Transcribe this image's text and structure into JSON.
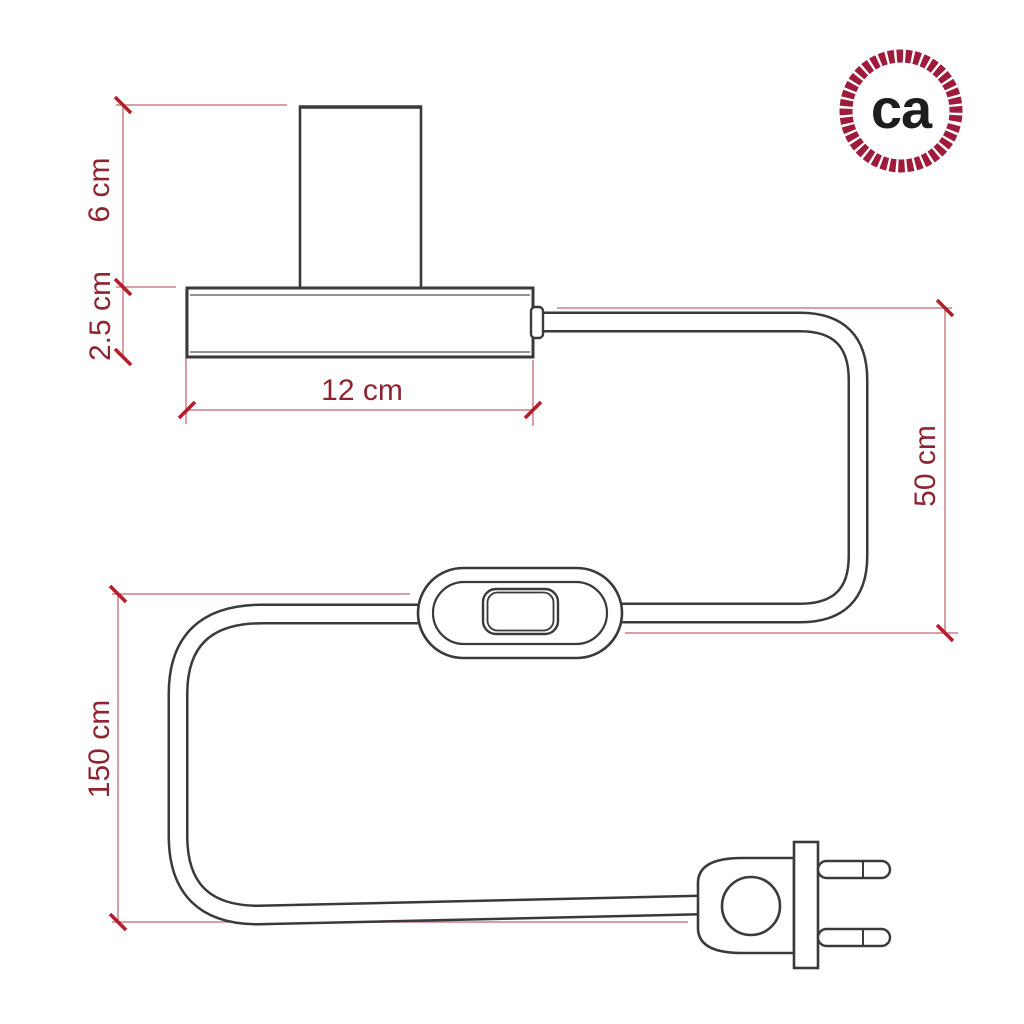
{
  "canvas": {
    "width": 1024,
    "height": 1024,
    "background": "#ffffff"
  },
  "logo": {
    "text": "ca",
    "ring_color": "#9e1b3c",
    "text_color": "#1d1d1b"
  },
  "dimensions": {
    "socket_height": "6 cm",
    "base_height": "2.5 cm",
    "base_width": "12 cm",
    "cable_base_to_switch": "50 cm",
    "cable_switch_to_plug": "150 cm"
  },
  "colors": {
    "outline": "#3a3a3a",
    "dimension_line": "#ca8089",
    "dimension_tick": "#b2202c",
    "dimension_label": "#8e2430",
    "logo_ring": "#9e1b3c"
  }
}
